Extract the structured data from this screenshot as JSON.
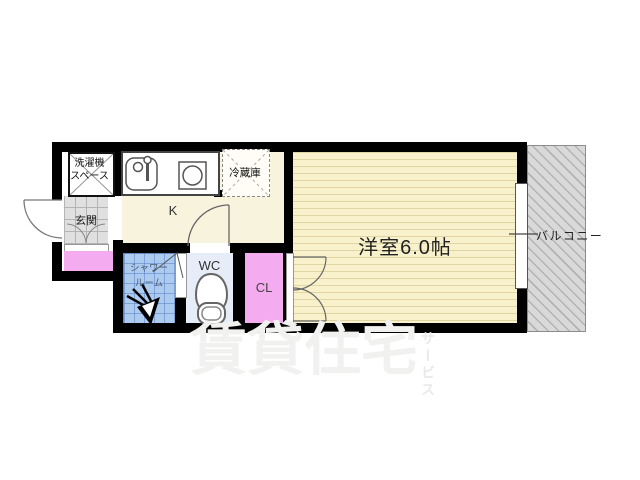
{
  "plan": {
    "type": "apartment-floor-plan",
    "labels": {
      "washer_line1": "洗濯機",
      "washer_line2": "スペース",
      "fridge": "冷蔵庫",
      "kitchen": "K",
      "entrance": "玄関",
      "shower_line1": "シャワー",
      "shower_line2": "ルーム",
      "wc": "WC",
      "closet": "CL",
      "main_room": "洋室6.0帖",
      "balcony": "バルコニー"
    },
    "colors": {
      "wall": "#000000",
      "kitchen_floor": "#f7f3dd",
      "main_room_floor": "#f8f1cb",
      "closet_pink": "#f5abef",
      "shower_blue": "#accbee",
      "wc_floor": "#e6edf8",
      "entrance_tile": "#e0e0e0",
      "balcony_gray": "#d9d9d9",
      "watermark_gray": "#f1f1ef"
    }
  },
  "watermark": {
    "main": "賃貸住宅",
    "sub": "サービス"
  }
}
